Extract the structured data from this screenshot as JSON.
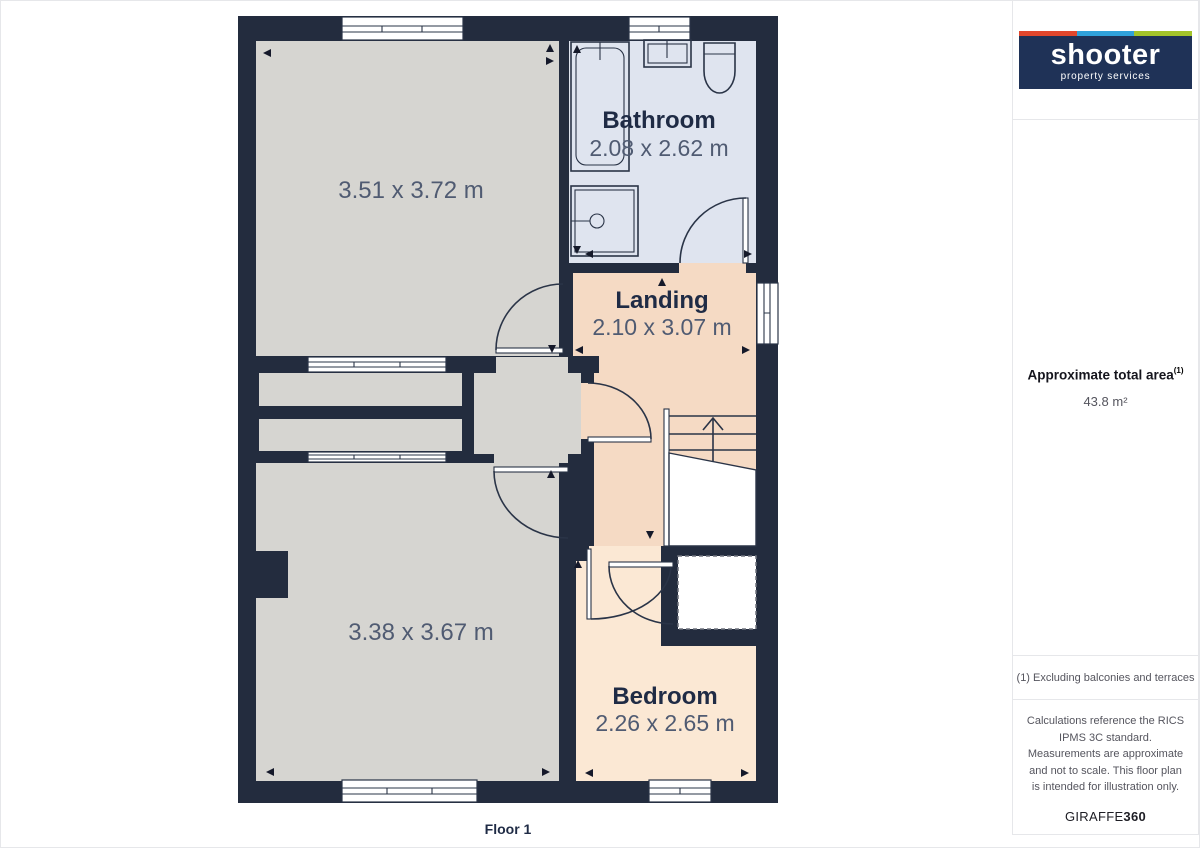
{
  "brand": {
    "name": "shooter",
    "tagline": "property services"
  },
  "sidebar": {
    "area_title": "Approximate total area",
    "area_footnote_marker": "(1)",
    "area_value": "43.8 m²",
    "footnote": "(1) Excluding balconies and terraces",
    "disclaimer": "Calculations reference the RICS IPMS 3C standard. Measurements are approximate and not to scale. This floor plan is intended for illustration only.",
    "watermark": {
      "prefix": "GIRAFFE",
      "suffix": "360"
    }
  },
  "plan": {
    "floor_label": "Floor 1",
    "rooms": [
      {
        "id": "room-top-left",
        "name": "",
        "dimensions": "3.51 x 3.72 m"
      },
      {
        "id": "bathroom",
        "name": "Bathroom",
        "dimensions": "2.08 x 2.62 m"
      },
      {
        "id": "landing",
        "name": "Landing",
        "dimensions": "2.10 x 3.07 m"
      },
      {
        "id": "room-bottom-left",
        "name": "",
        "dimensions": "3.38 x 3.67 m"
      },
      {
        "id": "bedroom",
        "name": "Bedroom",
        "dimensions": "2.26 x 2.65 m"
      }
    ]
  },
  "colors": {
    "wall": "#232c3e",
    "room_gray": "#d6d5d1",
    "bathroom": "#dfe4ef",
    "landing": "#f5dac4",
    "bedroom": "#fbe8d4",
    "line": "#2a3447",
    "label": "#1f2b45",
    "dim_text": "#505b72",
    "navy": "#1f3257",
    "stripe_red": "#e2472d",
    "stripe_blue": "#30a2db",
    "stripe_green": "#a3c42a",
    "border": "#e6e7ea",
    "muted_text": "#55555e"
  }
}
